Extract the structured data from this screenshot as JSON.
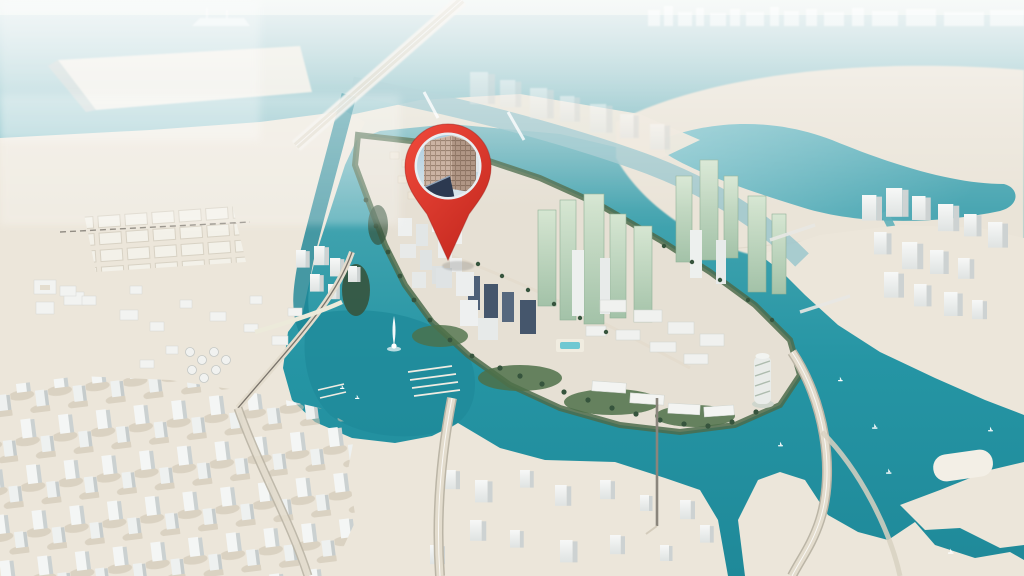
{
  "image": {
    "kind": "3d-aerial-masterplan-render",
    "subject": "Waterfront island city development with surrounding bay, sandy mainland districts and highways",
    "marker": "red location pin with circular photo of a beige high-rise tower, pointing to a parcel at the centre of the island"
  },
  "pin": {
    "role": "location-marker",
    "points_to": "island development centre",
    "photo_subject": "beige high-rise tower with grid of windows against blue sky"
  },
  "regions": {
    "north": "hazy sea with distant skyline, faint ship and pale sand spit",
    "northeast": "reclaimed sand landmass with inner teal lagoon",
    "centre": "oval island with green shoreline, glass towers, low-rise blocks, marina with fountain and spiral tower",
    "west": "mainland sand with plot grid, storage tanks and scattered white buildings",
    "southwest": "dense district of white massing-model blocks",
    "south": "white block district, elevated highways and teal bay with sailboats",
    "east": "white tower cluster on sand beside the bay"
  },
  "colors": {
    "sky_top": "#eaf1ee",
    "sky_sea": "#c7dcde",
    "sea_band": "#b3cfd3",
    "water_shallow": "#c9dee0",
    "water_pale": "#8cc2c8",
    "water_mid": "#3fa2ae",
    "water_teal": "#2595a4",
    "water_deep": "#1f8999",
    "canal_deep": "#1b8495",
    "marina_teal": "#1f8a9a",
    "lagoon_1": "#8fcad1",
    "lagoon_2": "#4aa6b2",
    "sand": "#ece6da",
    "sand_far": "#eae4d8",
    "sand_spit": "#f0ede4",
    "sand_bar": "#f3efe6",
    "island_sand": "#e6e0d4",
    "green_fringe": "#4c6b4b",
    "green_dark": "#36543d",
    "green_lawn": "#4e7049",
    "building_white": "#f7f8f7",
    "building_side": "#dfe3e2",
    "building_side2": "#cdd2d2",
    "building_dark": "#45566c",
    "glass_green_1": "#d6e6d2",
    "glass_green_2": "#a3c2a8",
    "road_light": "#e3dccd",
    "road_casing": "#bbb5a6",
    "rail_dark": "#55504a",
    "pin_red_1": "#f14a3c",
    "pin_red_2": "#c62a20",
    "pin_ring": "#e8eef2",
    "photo_sky_1": "#aacbdd",
    "photo_sky_2": "#dce7ec",
    "photo_facade": "#cbb3a3",
    "photo_facade_shade": "#b09685",
    "photo_wedge": "#2c3950",
    "white": "#ffffff"
  }
}
